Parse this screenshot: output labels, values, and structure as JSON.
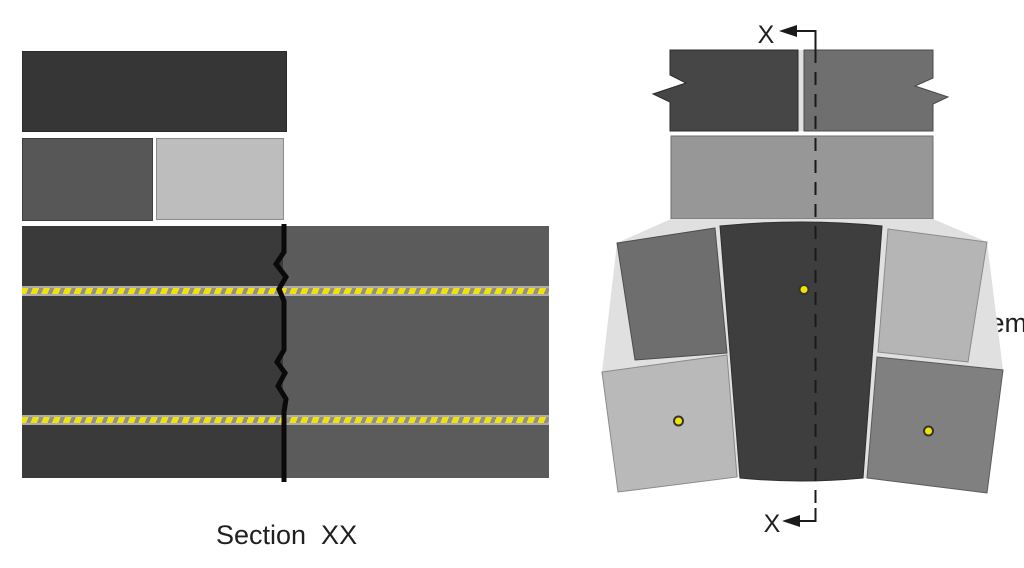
{
  "legend": {
    "label": "Cem  Flex"
  },
  "section_label": "Section  XX",
  "section_marks": {
    "top": "X",
    "bottom": "X"
  },
  "colors": {
    "background": "#ffffff",
    "text": "#1f1f1f",
    "brick_dark": "#363636",
    "brick_mid_dark": "#575757",
    "brick_light": "#bdbdbd",
    "block_left": "#3a3a3a",
    "block_right": "#5b5b5b",
    "crack": "#0a0a0a",
    "rope_yellow": "#f2e20a",
    "rope_gray": "#8f8f8f",
    "rope_edge": "#ababab",
    "marker_yellow": "#f2e205",
    "marker_outline": "#333333",
    "mortar": "#e0e0e0",
    "elev_brick1_left": "#464646",
    "elev_brick1_right": "#6f6f6f",
    "elev_brick2": "#979797",
    "elev_keystone": "#3e3e3e",
    "elev_mid_left": "#6e6e6e",
    "elev_mid_right": "#b5b5b5",
    "elev_bottom_left": "#b9b9b9",
    "elev_bottom_right": "#808080",
    "cut_line": "#1a1a1a"
  }
}
